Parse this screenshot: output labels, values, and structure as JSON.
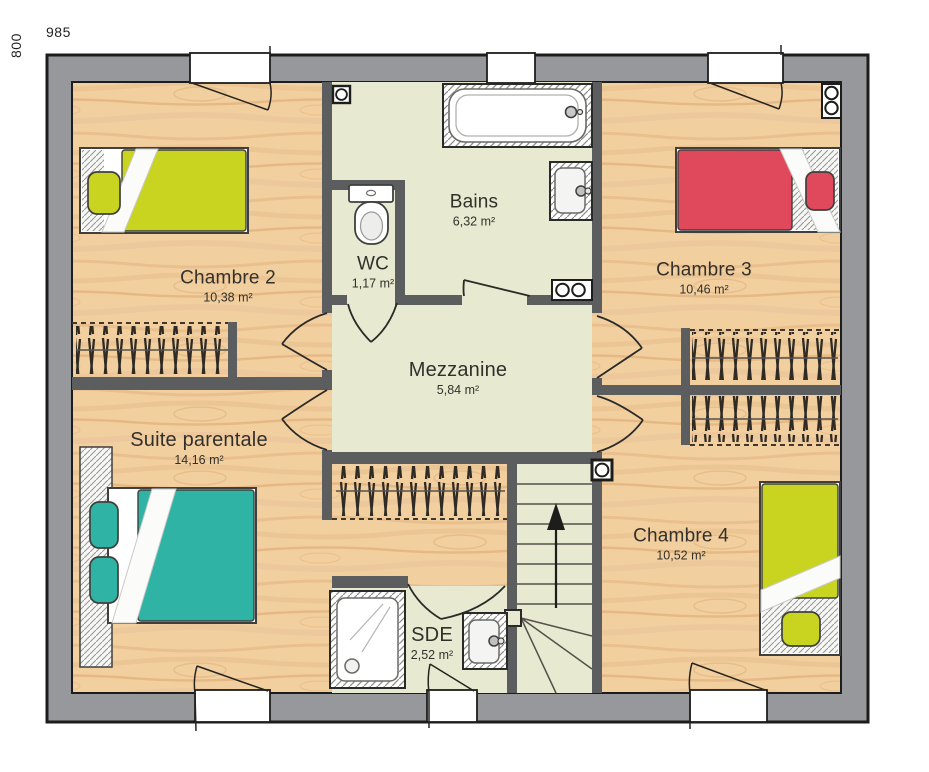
{
  "dimensions": {
    "width_label": "985",
    "height_label": "800"
  },
  "rooms": {
    "chambre2": {
      "name": "Chambre 2",
      "area": "10,38 m²"
    },
    "wc": {
      "name": "WC",
      "area": "1,17 m²"
    },
    "bains": {
      "name": "Bains",
      "area": "6,32 m²"
    },
    "chambre3": {
      "name": "Chambre 3",
      "area": "10,46 m²"
    },
    "mezzanine": {
      "name": "Mezzanine",
      "area": "5,84 m²"
    },
    "suite_parentale": {
      "name": "Suite parentale",
      "area": "14,16 m²"
    },
    "chambre4": {
      "name": "Chambre 4",
      "area": "10,52 m²"
    },
    "sde": {
      "name": "SDE",
      "area": "2,52 m²"
    }
  },
  "icons": [
    "bathtub",
    "washbasin",
    "toilet",
    "shower",
    "double-bed",
    "single-bed",
    "stairs",
    "stairs-up-arrow",
    "radiator",
    "ceiling-spot",
    "wardrobe-hangers",
    "door-swing",
    "window-casement"
  ],
  "colors": {
    "outer_wall": "#96989b",
    "inner_wall": "#5c5d5f",
    "outline": "#1d1d1b",
    "wood_floor": "#f2cf9f",
    "tile_floor": "#e8e9d1",
    "bed_yellow": "#c9d420",
    "bed_red": "#e0495c",
    "bed_teal": "#2eb3a4"
  }
}
